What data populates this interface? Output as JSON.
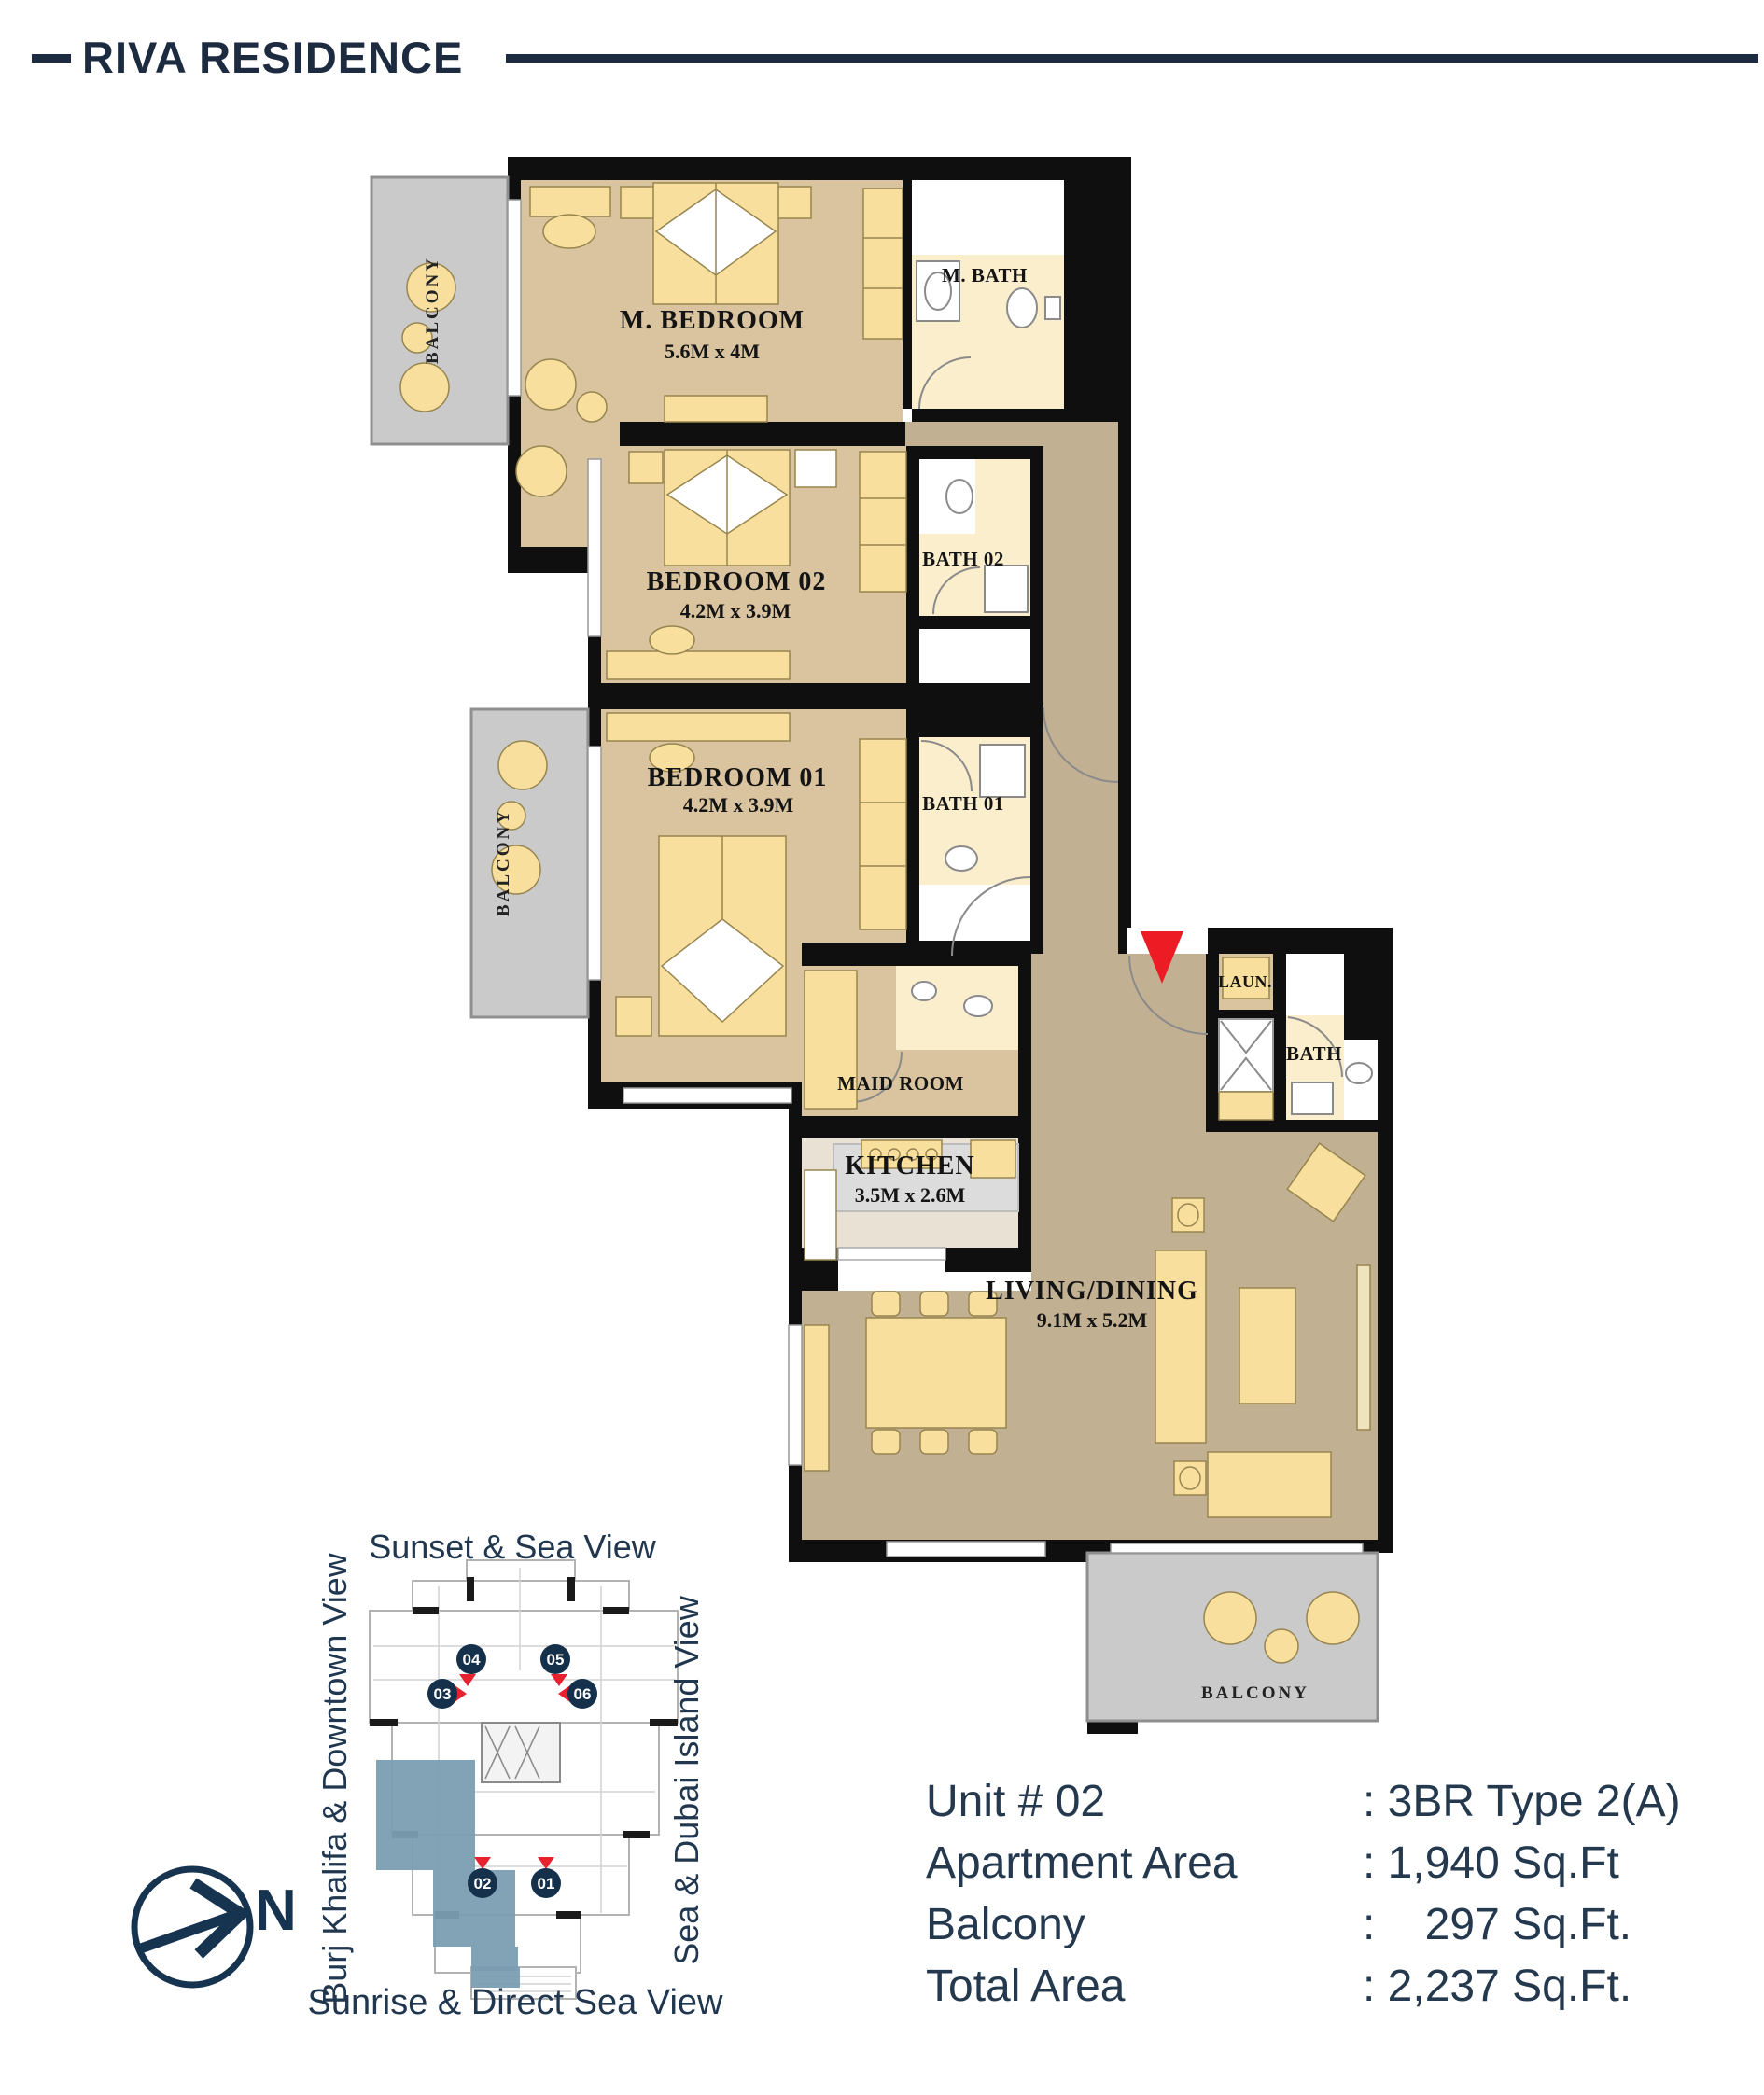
{
  "colors": {
    "brand_navy": "#1d2b40",
    "plan_wall_black": "#0f0f0f",
    "room_tan": "#d9c49f",
    "hall_tan": "#c2b093",
    "bath_cream": "#fbeecd",
    "furniture_yellow": "#f8df9e",
    "balcony_gray": "#cacaca",
    "kitchen_gray": "#dcdcdc",
    "kitchen_beige": "#e9e1d3",
    "accent_red": "#ed1c24",
    "keyplan_highlight_blue": "#7b9db2",
    "badge_navy": "#14304b"
  },
  "header": {
    "brand": "RIVA RESIDENCE"
  },
  "floor_plan": {
    "rooms": {
      "m_bedroom": {
        "name": "M. BEDROOM",
        "dims": "5.6M x 4M"
      },
      "m_bath": {
        "name": "M. BATH"
      },
      "bedroom_02": {
        "name": "BEDROOM 02",
        "dims": "4.2M x 3.9M"
      },
      "bath_02": {
        "name": "BATH 02"
      },
      "bedroom_01": {
        "name": "BEDROOM 01",
        "dims": "4.2M x 3.9M"
      },
      "bath_01": {
        "name": "BATH 01"
      },
      "maid_room": {
        "name": "MAID ROOM"
      },
      "kitchen": {
        "name": "KITCHEN",
        "dims": "3.5M x 2.6M"
      },
      "living_dining": {
        "name": "LIVING/DINING",
        "dims": "9.1M x 5.2M"
      },
      "laundry": {
        "name": "LAUN."
      },
      "bath": {
        "name": "BATH"
      }
    },
    "balconies": [
      "BALCONY",
      "BALCONY",
      "BALCONY"
    ]
  },
  "key_plan": {
    "views": {
      "top": "Sunset & Sea View",
      "left": "Burj Khalifa & Downtown View",
      "right": "Sea & Dubai Island View",
      "bottom": "Sunrise & Direct Sea View"
    },
    "units": [
      "04",
      "05",
      "03",
      "06",
      "02",
      "01"
    ],
    "north": "N"
  },
  "unit_info": {
    "rows": [
      {
        "label": "Unit # 02",
        "value": ": 3BR Type 2(A)"
      },
      {
        "label": "Apartment Area",
        "value": ": 1,940 Sq.Ft"
      },
      {
        "label": "Balcony",
        "value": ":    297 Sq.Ft."
      },
      {
        "label": "Total Area",
        "value": ": 2,237 Sq.Ft."
      }
    ]
  }
}
